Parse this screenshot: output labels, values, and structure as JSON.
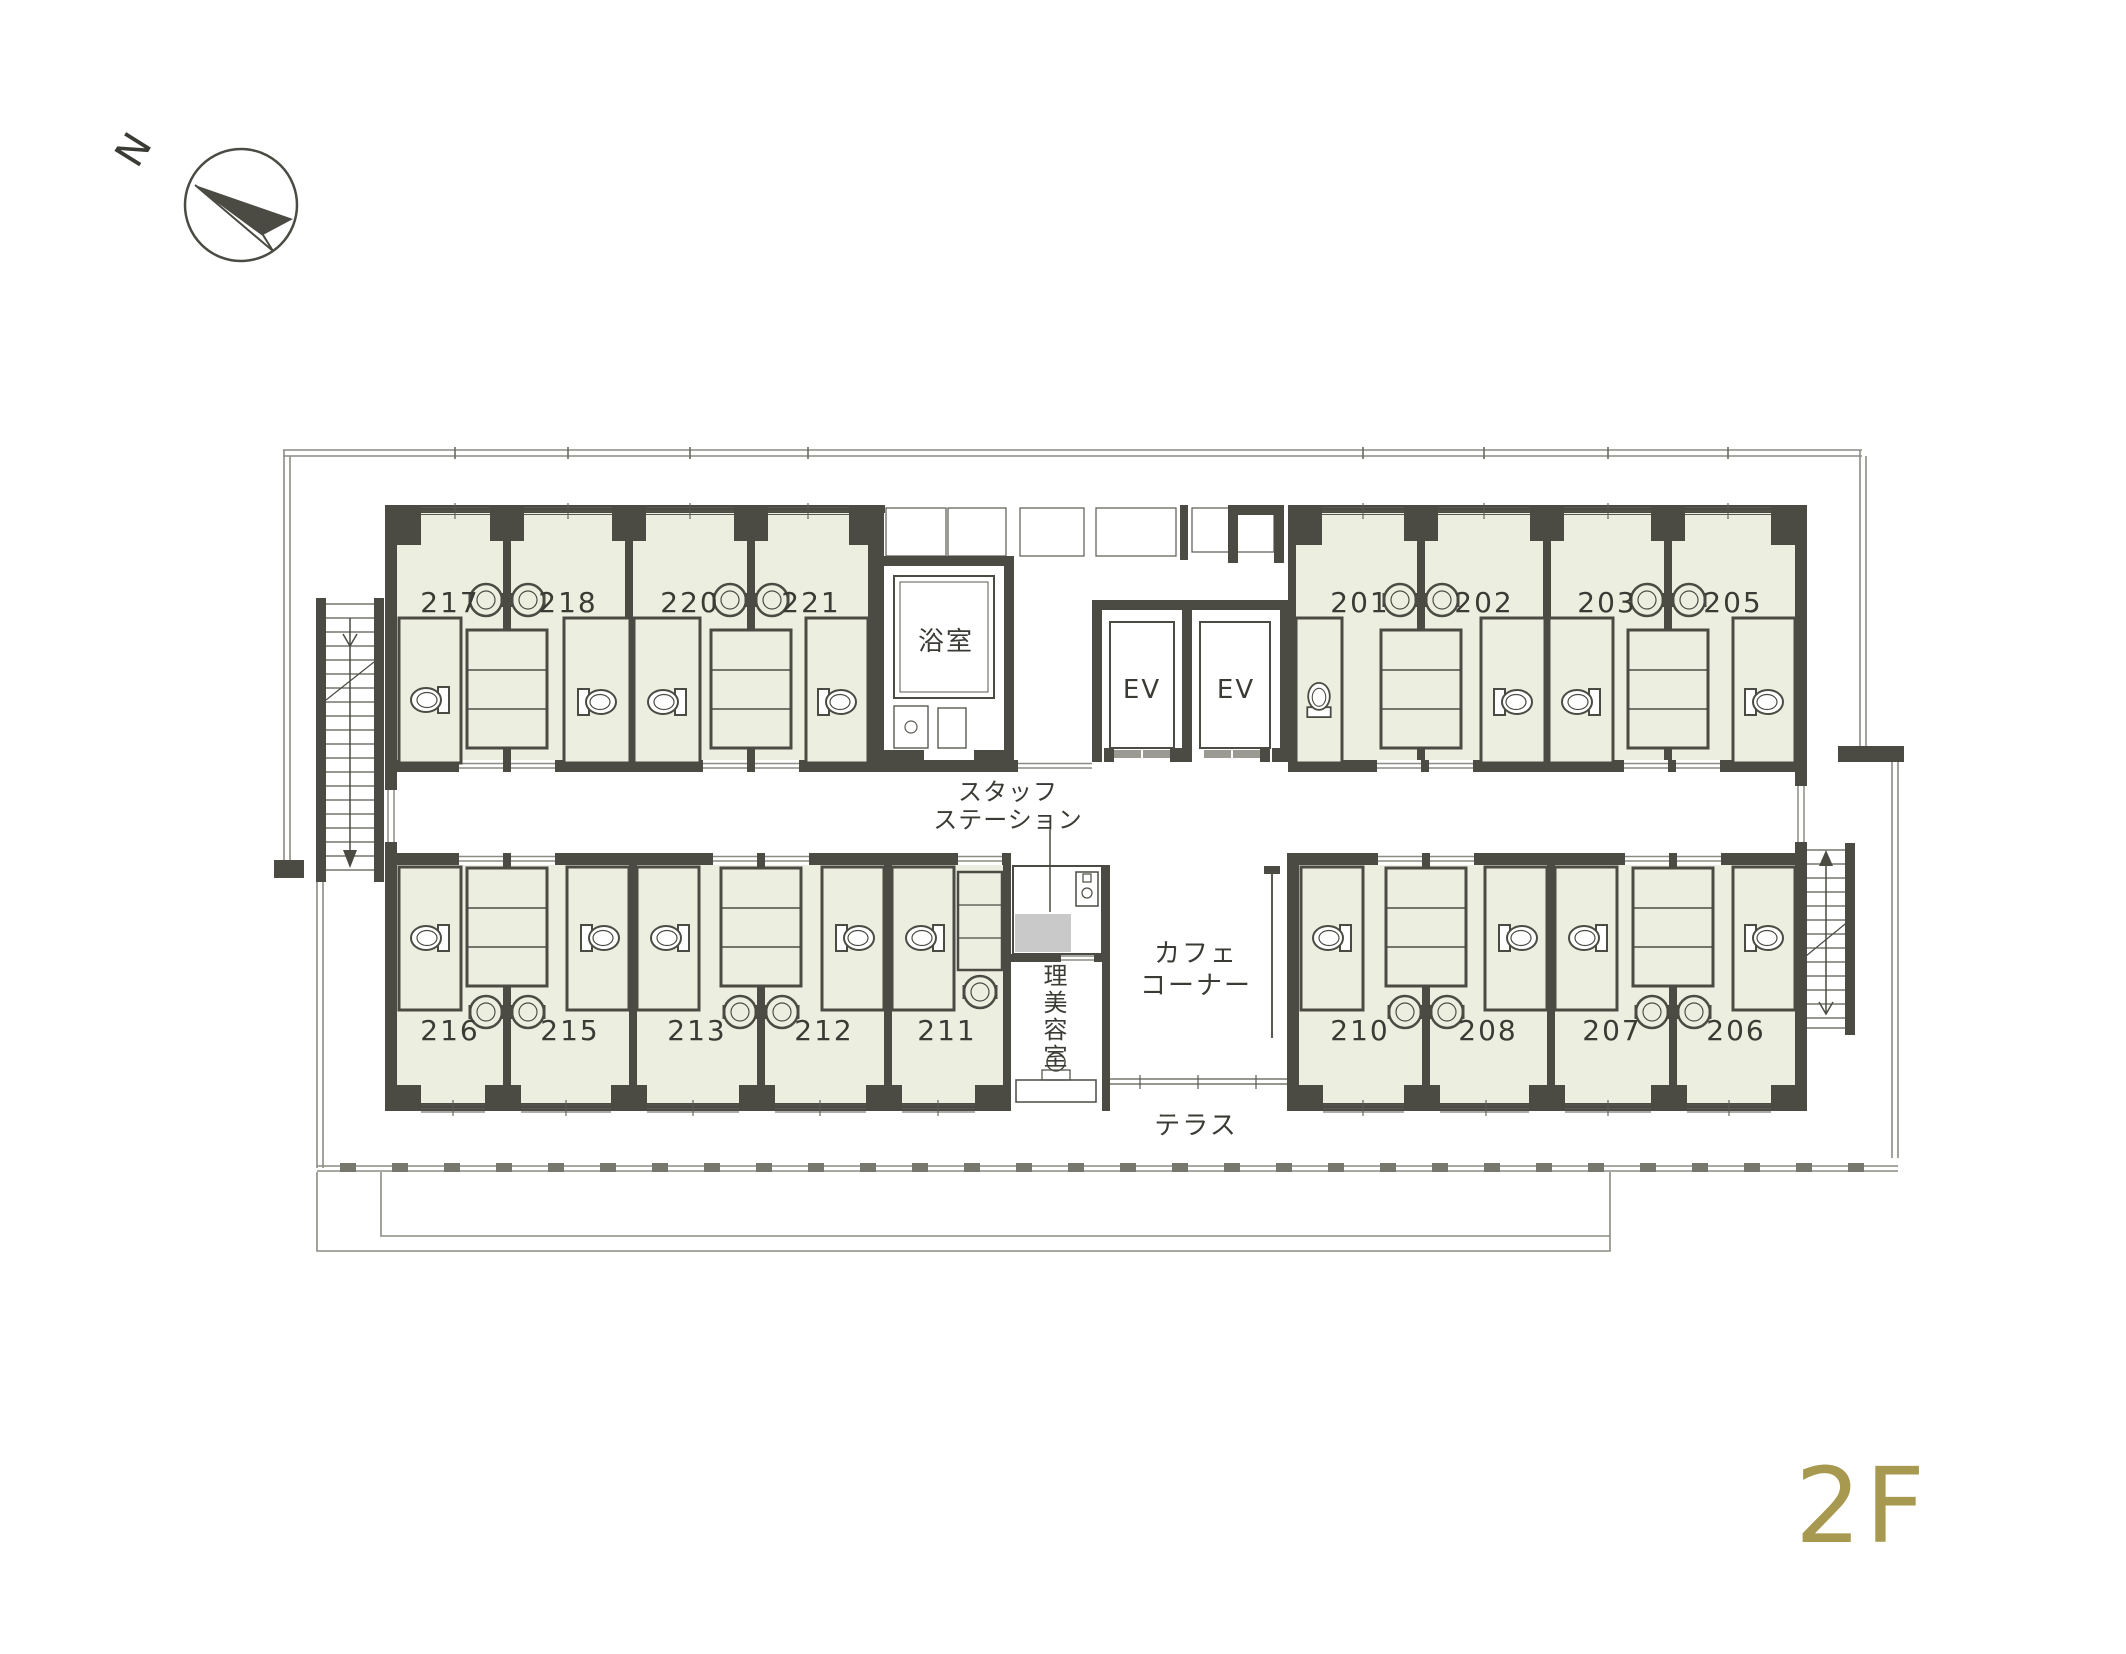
{
  "floor_label": "2F",
  "compass": {
    "north": "N"
  },
  "rooms": {
    "r217": "217",
    "r218": "218",
    "r220": "220",
    "r221": "221",
    "r201": "201",
    "r202": "202",
    "r203": "203",
    "r205": "205",
    "r216": "216",
    "r215": "215",
    "r213": "213",
    "r212": "212",
    "r211": "211",
    "r210": "210",
    "r208": "208",
    "r207": "207",
    "r206": "206"
  },
  "areas": {
    "bath": "浴室",
    "ev": "EV",
    "staff_line1": "スタッフ",
    "staff_line2": "ステーション",
    "salon": "理美容室",
    "cafe_line1": "カフェ",
    "cafe_line2": "コーナー",
    "terrace": "テラス"
  },
  "colors": {
    "wall": "#4B4B44",
    "room_fill": "#ECEEDF",
    "accent_gold": "#A7994F",
    "staff_fill": "#C9C9C9",
    "outline_gray": "#8C8C84"
  }
}
